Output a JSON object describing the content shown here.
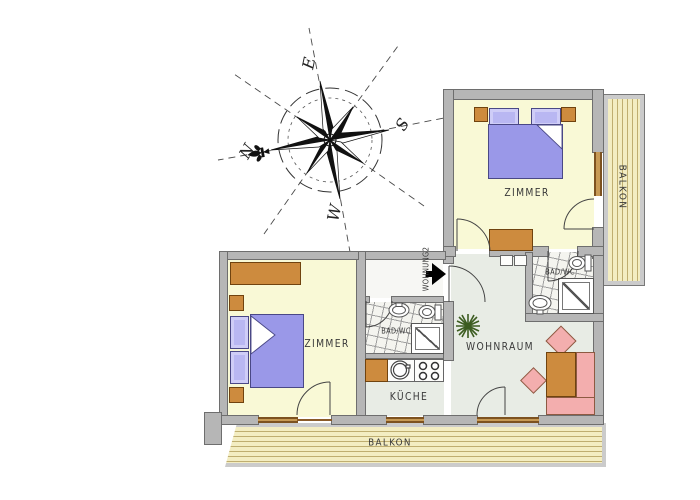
{
  "compass": {
    "north": "N",
    "east": "E",
    "south": "S",
    "west": "W"
  },
  "labels": {
    "bedroom_upper": "ZIMMER",
    "bedroom_lower": "ZIMMER",
    "bathroom_upper": "BAD/WC",
    "bathroom_lower": "BAD/WC",
    "kitchen": "KÜCHE",
    "living_room": "WOHNRAUM",
    "balcony_bottom": "BALKON",
    "balcony_right": "BALKON",
    "apartment_entrance": "WOHNUNG2"
  },
  "colors": {
    "wall": "#b6b6b6",
    "bedroom_floor": "#f9f9d6",
    "living_floor": "#e8ece5",
    "bed_purple": "#9a98e8",
    "pillow_purple": "#b9b7f2",
    "wood_furniture": "#cd8b3e",
    "sofa_pink": "#f3aeae",
    "balcony_wood": "#f3edc2",
    "window_wood": "#8a5a28",
    "plant_green": "#3c5c20"
  }
}
